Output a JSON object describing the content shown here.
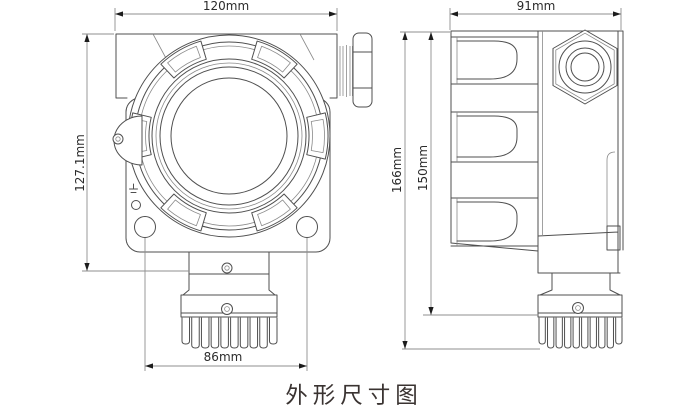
{
  "drawing": {
    "title": "外形尺寸图",
    "front_view": {
      "width_label": "120mm",
      "height_label": "127.1mm",
      "hole_spacing_label": "86mm"
    },
    "side_view": {
      "width_label": "91mm",
      "total_height_label": "166mm",
      "body_height_label": "150mm"
    }
  },
  "theme": {
    "background": "#ffffff",
    "line_color": "#4f4f4f",
    "dim_line_color": "#8f8f8f",
    "arrow_color": "#1c1c1c",
    "text_color": "#2b2b2b",
    "title_color": "#3a3331"
  }
}
